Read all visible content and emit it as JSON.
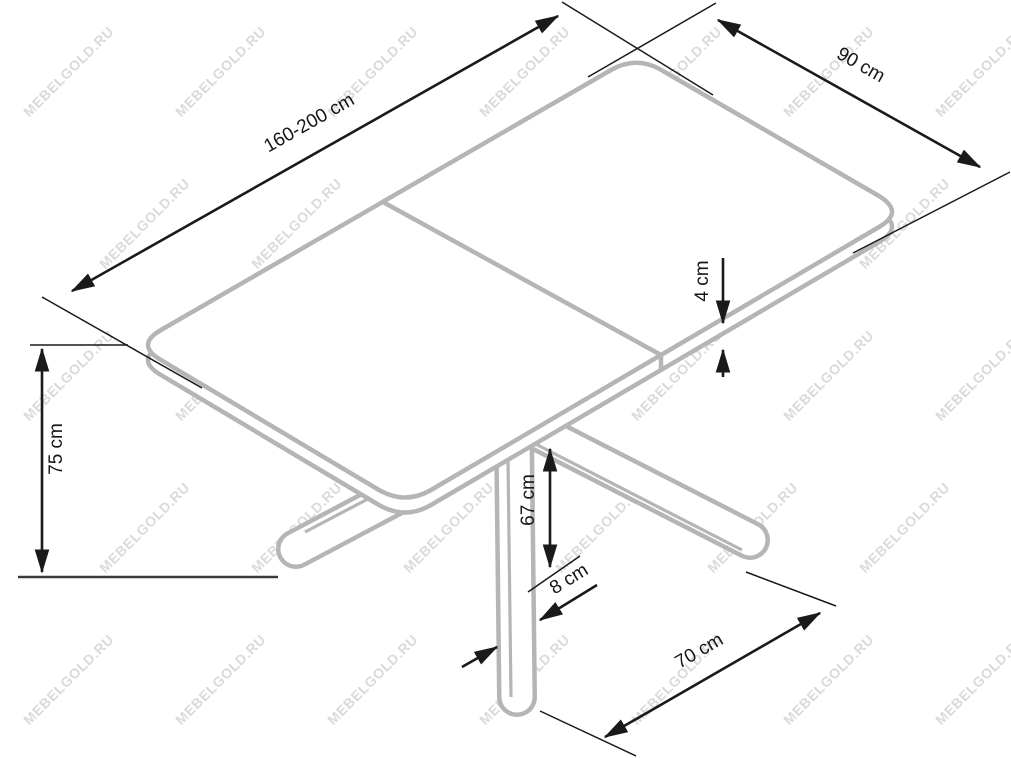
{
  "diagram": {
    "type": "furniture-dimension-drawing",
    "subject": "extendable-table-isometric-view",
    "background_color": "#ffffff",
    "outline_color": "#b5b5b5",
    "dimension_color": "#1a1a1a",
    "watermark": {
      "text": "MEBELGOLD.RU",
      "color": "#dadada"
    },
    "dimensions": [
      {
        "id": "length",
        "label": "160-200 cm",
        "measures": "table-top-length"
      },
      {
        "id": "width",
        "label": "90 cm",
        "measures": "table-top-width"
      },
      {
        "id": "thickness",
        "label": "4 cm",
        "measures": "table-top-thickness"
      },
      {
        "id": "height",
        "label": "75 cm",
        "measures": "overall-height"
      },
      {
        "id": "clearance",
        "label": "67 cm",
        "measures": "under-top-leg-height"
      },
      {
        "id": "leg_width",
        "label": "8 cm",
        "measures": "leg-width"
      },
      {
        "id": "base_spread",
        "label": "70 cm",
        "measures": "base-foot-spread"
      }
    ]
  }
}
